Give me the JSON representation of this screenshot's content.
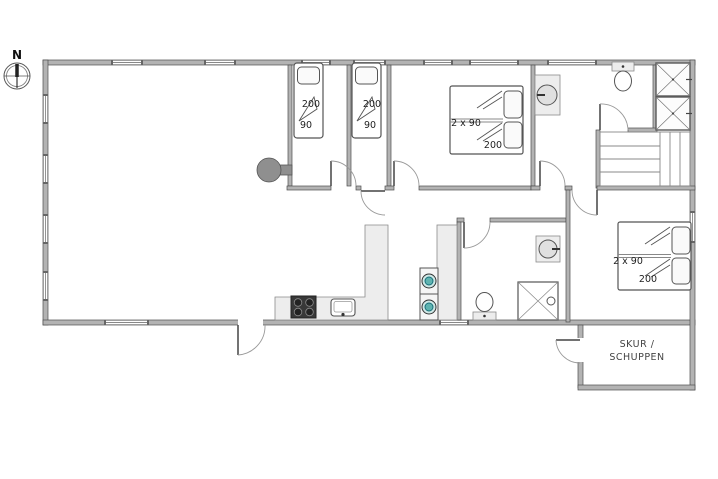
{
  "plan": {
    "compass": {
      "label": "N"
    },
    "beds": {
      "bed1": {
        "length": "200",
        "width": "90"
      },
      "bed2": {
        "length": "200",
        "width": "90"
      },
      "bed3": {
        "size": "2 x 90",
        "length": "200"
      },
      "bed4": {
        "size": "2 x 90",
        "length": "200"
      }
    },
    "shed": {
      "label_line1": "SKUR /",
      "label_line2": "SCHUPPEN"
    },
    "fixture_legend": [
      "north-compass",
      "wood-burning-stove",
      "single-bed",
      "double-bed",
      "wardrobe",
      "staircase",
      "toilet",
      "washbasin",
      "shower",
      "washer-dryer-stack",
      "kitchen-hob",
      "kitchen-sink",
      "kitchen-counter"
    ],
    "colors": {
      "wall": "#b3b3b3",
      "wall_edge": "#4f4f4f",
      "fixture_fill": "#ededed",
      "hob": "#383838",
      "appliance_accent": "#5fb3b0",
      "text": "#222222"
    }
  }
}
